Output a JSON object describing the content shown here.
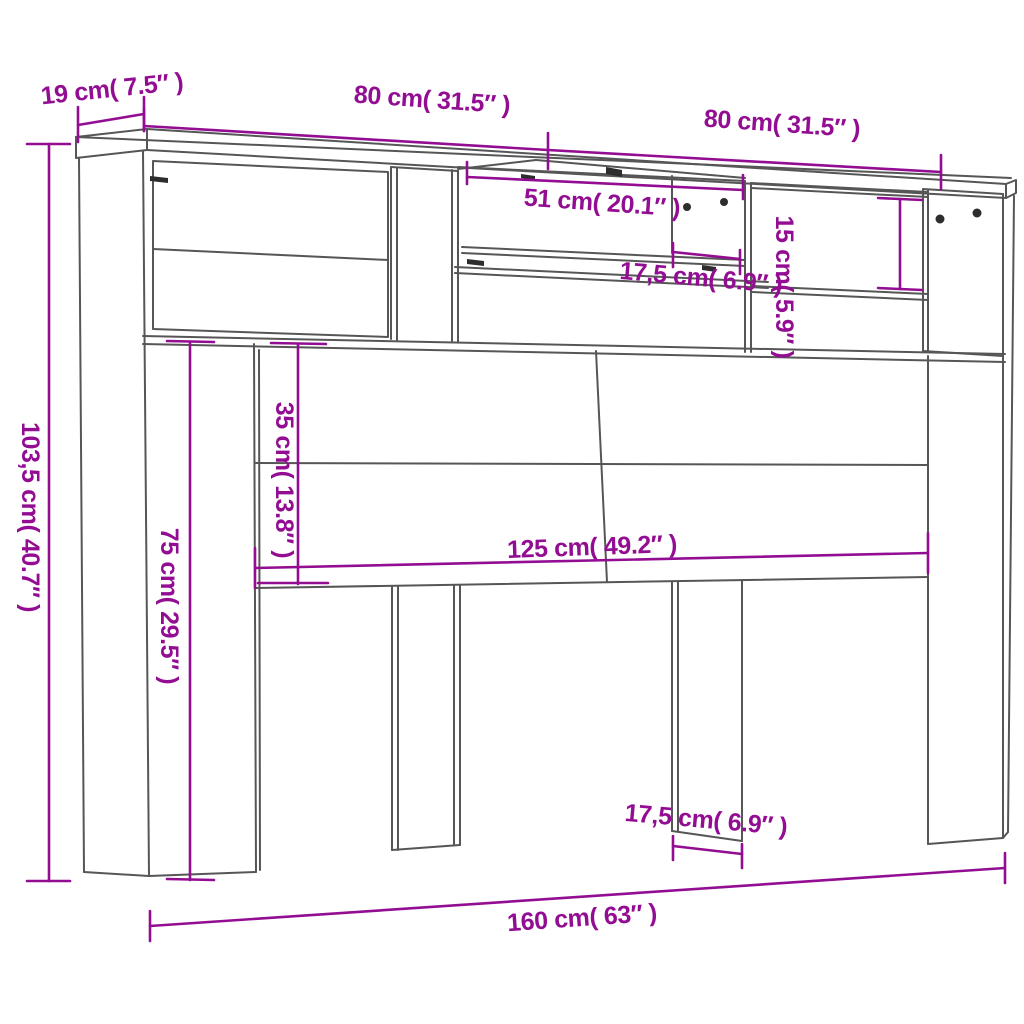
{
  "diagram": {
    "dimensions": {
      "depth_top": "19 cm( 7.5″ )",
      "total_height": "103,5 cm( 40.7″ )",
      "width_top_left": "80 cm( 31.5″ )",
      "width_top_right": "80 cm( 31.5″ )",
      "middle_opening_width": "51 cm( 20.1″ )",
      "right_opening_height": "15 cm( 5.9″ )",
      "upper_shelf_width": "17,5 cm( 6.9″ )",
      "backboard_height": "35 cm( 13.8″ )",
      "leg_height": "75 cm( 29.5″ )",
      "backboard_width": "125 cm( 49.2″ )",
      "leg_width": "17,5 cm( 6.9″ )",
      "total_width": "160 cm( 63″ )"
    },
    "colors": {
      "dimension_accent": "#930d93",
      "outline_gray": "#565656",
      "background": "#ffffff"
    }
  }
}
